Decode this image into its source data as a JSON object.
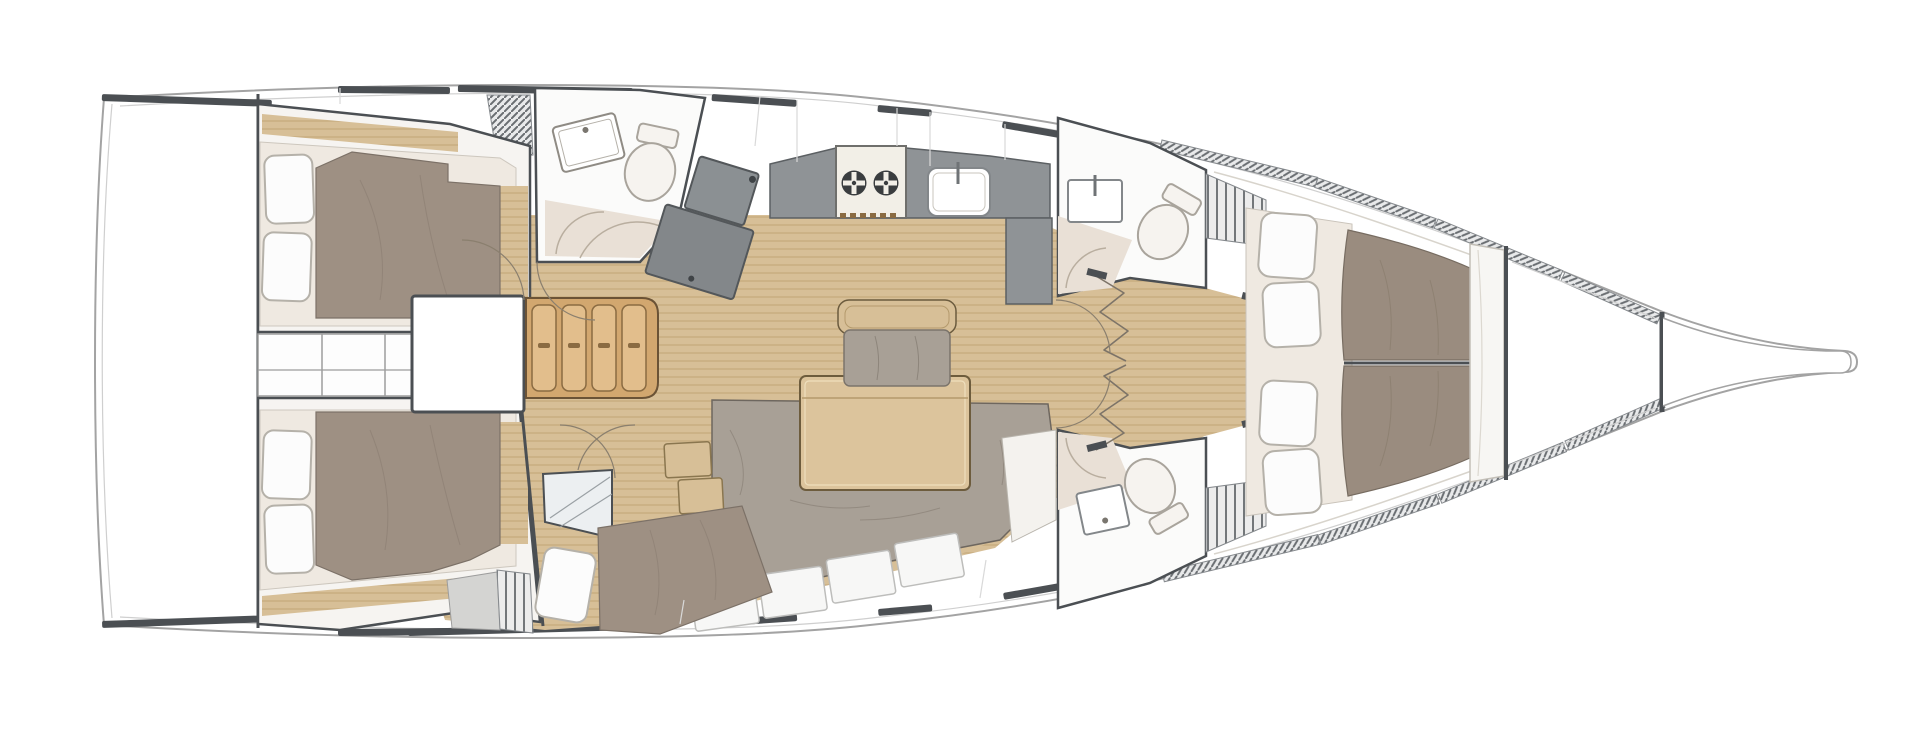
{
  "meta": {
    "type": "yacht-interior-floor-plan",
    "view": "top-down deck plan",
    "orientation": "bow-right",
    "visible_text": "none"
  },
  "theme": {
    "colors": {
      "wood": "#d7bf97",
      "woodLine": "#c2a677",
      "stepsWood": "#d2a76f",
      "stepsTread": "#e2be8c",
      "stepsLine": "#8a6b42",
      "mattress": "#9e9083",
      "mattressFwd": "#9a8c7f",
      "cushion": "#a8a096",
      "cushionLine": "#8d857b",
      "counter": "#8f9396",
      "counterLine": "#5c6063",
      "navDesk": "#83878a",
      "bedBase": "#efe9e1",
      "pillow": "#fcfcfc",
      "pillowLine": "#b5b1a9",
      "shower": "#e9e0d6",
      "showerLine": "#b9ae9f",
      "wall": "#4b4f53",
      "hull": "#a3a3a3",
      "hullInner": "#cfcfcf",
      "panel": "#f6f4f1",
      "fixture": "#f6f3ef",
      "fixtureLine": "#a9a49c",
      "lockerLine": "#9d9d9d",
      "seam": "#d9d9d9",
      "arc": "#8a7f6e",
      "white": "#ffffff"
    }
  },
  "regions": {
    "hull": {
      "label": "hull outline, bow pointing right"
    },
    "swim_platform": {
      "label": "transom swim platform"
    },
    "aft_cabin_port": {
      "label": "port aft double cabin",
      "pillows": 2
    },
    "aft_cabin_starboard": {
      "label": "starboard aft double cabin",
      "pillows": 2
    },
    "mid_lockers": {
      "label": "central locker row between aft cabins",
      "cells": 3
    },
    "engine_box": {
      "label": "engine compartment under companionway"
    },
    "steps": {
      "label": "companionway steps",
      "treads": 4
    },
    "aft_head": {
      "label": "aft head with sink, toilet and shower"
    },
    "nav_station": {
      "label": "chart table / navigation station"
    },
    "galley": {
      "label": "galley with two-burner stove and sink",
      "burners": 2
    },
    "salon_table": {
      "label": "saloon table"
    },
    "armchair": {
      "label": "saloon armchair"
    },
    "settee": {
      "label": "L-shaped saloon settee"
    },
    "bunk_cabin": {
      "label": "starboard mid single-berth cabin",
      "pillows": 1
    },
    "fwd_head_port": {
      "label": "port forward head"
    },
    "fwd_head_starboard": {
      "label": "starboard forward head"
    },
    "owners_cabin": {
      "label": "forward owner's cabin double berth",
      "pillows": 4
    },
    "forepeak": {
      "label": "forepeak / anchor locker"
    },
    "bowsprit": {
      "label": "bowsprit"
    }
  }
}
